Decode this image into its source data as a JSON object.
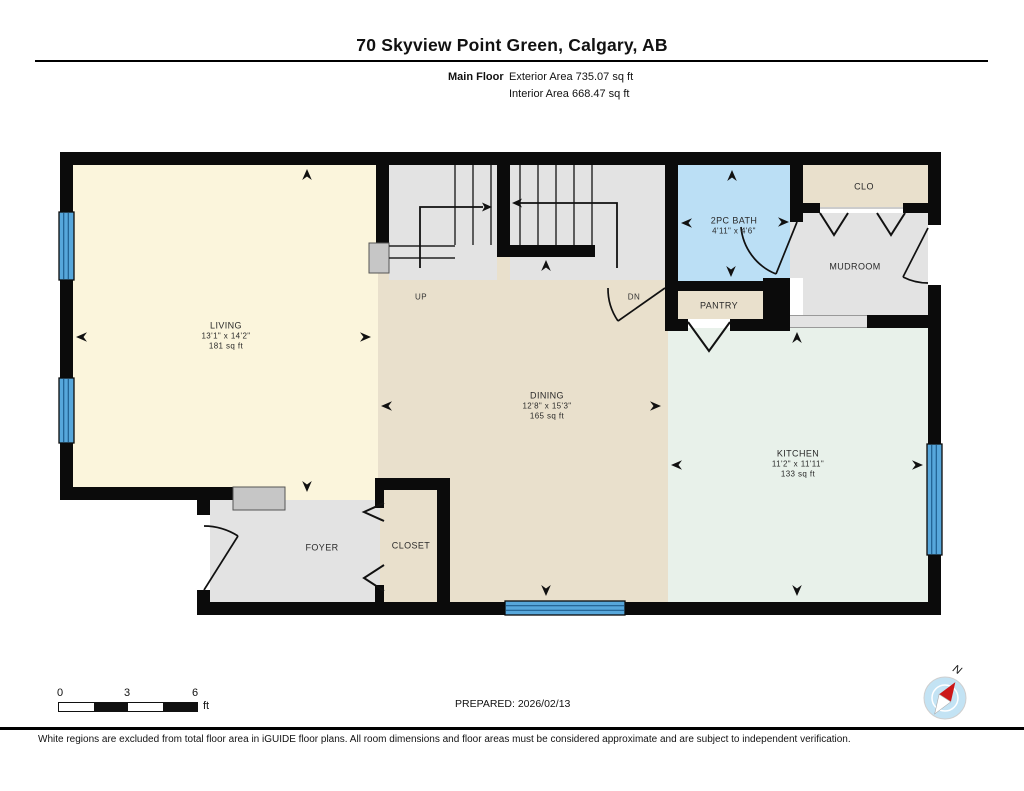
{
  "header": {
    "title": "70 Skyview Point Green, Calgary, AB",
    "floor_label": "Main Floor",
    "exterior_area": "Exterior Area 735.07 sq ft",
    "interior_area": "Interior Area 668.47 sq ft"
  },
  "rooms": {
    "living": {
      "name": "LIVING",
      "dims": "13'1\" x 14'2\"",
      "area": "181 sq ft"
    },
    "dining": {
      "name": "DINING",
      "dims": "12'8\" x 15'3\"",
      "area": "165 sq ft"
    },
    "kitchen": {
      "name": "KITCHEN",
      "dims": "11'2\" x 11'11\"",
      "area": "133 sq ft"
    },
    "bath": {
      "name": "2PC BATH",
      "dims": "4'11\" x 4'6\""
    },
    "mudroom": {
      "name": "MUDROOM"
    },
    "clo": {
      "name": "CLO"
    },
    "pantry": {
      "name": "PANTRY"
    },
    "foyer": {
      "name": "FOYER"
    },
    "closet": {
      "name": "CLOSET"
    },
    "stairs": {
      "up": "UP",
      "dn": "DN"
    }
  },
  "footer": {
    "scale": {
      "zero": "0",
      "three": "3",
      "six": "6",
      "unit": "ft"
    },
    "prepared": "PREPARED: 2026/02/13",
    "compass_label": "N",
    "disclaimer": "White regions are excluded from total floor area in iGUIDE floor plans. All room dimensions and floor areas must be considered approximate and are subject to independent verification."
  },
  "colors": {
    "wall": "#0b0b0b",
    "living": "#FBF5DC",
    "tan": "#E9E0CC",
    "kitchen": "#E8F1EA",
    "gray": "#E3E3E3",
    "bath": "#BBDFF5",
    "window": "#57A7DB",
    "block": "#C6C6C6",
    "compass": "#C3E3F4",
    "needle": "#CC1719"
  }
}
